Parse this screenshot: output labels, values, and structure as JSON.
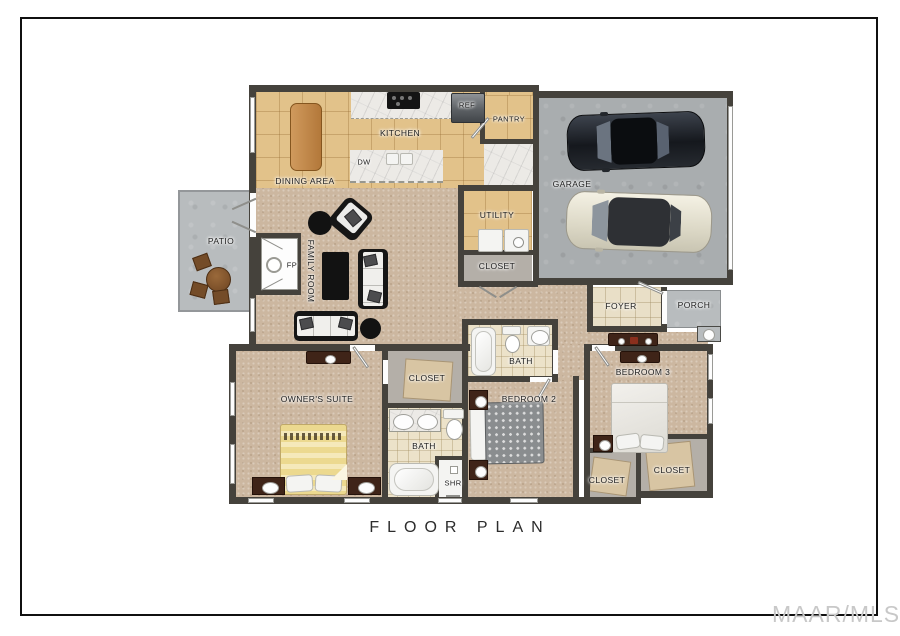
{
  "title": {
    "label": "FLOOR PLAN"
  },
  "watermark": {
    "label": "MAAR/MLS"
  },
  "palette": {
    "wall": "#45423c",
    "carpet": "#ccb7a0",
    "kitchen_tile": "#e2c28a",
    "bath_tile": "#ece2c9",
    "foyer_tile": "#e9dfc7",
    "garage_concrete": "#a9adaf",
    "patio_concrete": "#b8bcbe",
    "closet_floor": "#b4afa8",
    "counter_marble": "#eceae6",
    "watermark_gray": "#c8c8c8"
  },
  "rooms": {
    "kitchen": {
      "label": "KITCHEN"
    },
    "dining": {
      "label": "DINING AREA"
    },
    "pantry": {
      "label": "PANTRY"
    },
    "garage": {
      "label": "GARAGE"
    },
    "utility": {
      "label": "UTILITY"
    },
    "utility_closet": {
      "label": "CLOSET"
    },
    "patio": {
      "label": "PATIO"
    },
    "family_room": {
      "label": "FAMILY ROOM"
    },
    "foyer": {
      "label": "FOYER"
    },
    "porch": {
      "label": "PORCH"
    },
    "hall_bath": {
      "label": "BATH"
    },
    "owners_suite": {
      "label": "OWNER'S SUITE"
    },
    "walkin_closet": {
      "label": "CLOSET"
    },
    "owners_bath": {
      "label": "BATH"
    },
    "shower": {
      "label": "SHR"
    },
    "bedroom2": {
      "label": "BEDROOM 2"
    },
    "bedroom3": {
      "label": "BEDROOM 3"
    },
    "closet_bed3_a": {
      "label": "CLOSET"
    },
    "closet_bed3_b": {
      "label": "CLOSET"
    }
  },
  "appliances": {
    "refrigerator": {
      "label": "REF"
    },
    "dishwasher": {
      "label": "DW"
    },
    "fireplace": {
      "label": "FP"
    }
  }
}
